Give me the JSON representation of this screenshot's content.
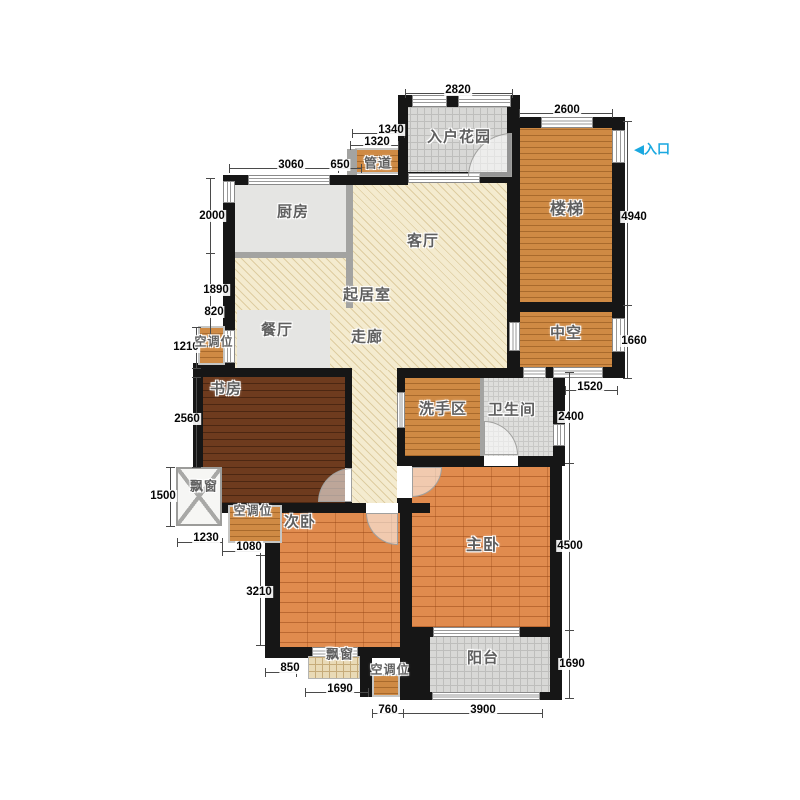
{
  "meta": {
    "title": "apartment-floor-plan",
    "canvas": {
      "w": 800,
      "h": 800
    }
  },
  "colors": {
    "wall": "#161616",
    "hatch_floor": "#f4ebcf",
    "wood_floor": "#cf8a44",
    "bedroom_floor": "#e08b4e",
    "study_floor": "#6e3b1e",
    "tile_floor": "#d8d8d6",
    "gray_floor": "#e5e5e3",
    "entrance_text": "#1aa8e0",
    "label_text": "#5f5f5f",
    "dim_text": "#060606"
  },
  "entrance": {
    "label": "入口",
    "arrow": "◀",
    "x": 652,
    "y": 148
  },
  "floors": [
    {
      "name": "living-room-floor",
      "cls": "f-hatch",
      "x": 235,
      "y": 180,
      "w": 273,
      "h": 190
    },
    {
      "name": "corridor-floor",
      "cls": "f-hatch",
      "x": 345,
      "y": 370,
      "w": 60,
      "h": 143
    },
    {
      "name": "kitchen-floor",
      "cls": "f-gray",
      "x": 235,
      "y": 183,
      "w": 112,
      "h": 70
    },
    {
      "name": "dining-floor",
      "cls": "f-gray",
      "x": 237,
      "y": 310,
      "w": 93,
      "h": 58
    },
    {
      "name": "entry-garden-floor",
      "cls": "f-tile",
      "x": 404,
      "y": 103,
      "w": 109,
      "h": 74
    },
    {
      "name": "stairs-floor",
      "cls": "f-wood",
      "x": 519,
      "y": 124,
      "w": 93,
      "h": 179
    },
    {
      "name": "hollow-floor",
      "cls": "f-wood",
      "x": 519,
      "y": 311,
      "w": 93,
      "h": 58
    },
    {
      "name": "duct-floor",
      "cls": "f-wood-framed",
      "x": 355,
      "y": 148,
      "w": 45,
      "h": 26
    },
    {
      "name": "study-floor",
      "cls": "f-wood-dark",
      "x": 203,
      "y": 377,
      "w": 142,
      "h": 126
    },
    {
      "name": "wash-area-floor",
      "cls": "f-wood",
      "x": 405,
      "y": 378,
      "w": 77,
      "h": 78
    },
    {
      "name": "bathroom-floor",
      "cls": "f-tile-dot",
      "x": 484,
      "y": 378,
      "w": 69,
      "h": 78
    },
    {
      "name": "master-bedroom-floor",
      "cls": "f-wood-bedroom",
      "x": 408,
      "y": 467,
      "w": 142,
      "h": 160
    },
    {
      "name": "second-bedroom-floor",
      "cls": "f-wood-bedroom",
      "x": 280,
      "y": 513,
      "w": 120,
      "h": 134
    },
    {
      "name": "balcony-floor",
      "cls": "f-tile",
      "x": 430,
      "y": 637,
      "w": 120,
      "h": 55
    }
  ],
  "partitions": [
    [
      346,
      183,
      7,
      125
    ],
    [
      235,
      252,
      118,
      6
    ],
    [
      480,
      378,
      4,
      78
    ],
    [
      347,
      149,
      10,
      26
    ]
  ],
  "walls": [
    [
      398,
      95,
      121,
      12
    ],
    [
      398,
      95,
      10,
      82
    ],
    [
      511,
      117,
      114,
      11
    ],
    [
      612,
      117,
      13,
      261
    ],
    [
      507,
      95,
      13,
      283
    ],
    [
      507,
      302,
      118,
      10
    ],
    [
      507,
      367,
      118,
      11
    ],
    [
      223,
      175,
      185,
      10
    ],
    [
      223,
      175,
      12,
      155
    ],
    [
      193,
      363,
      42,
      14
    ],
    [
      193,
      368,
      10,
      145
    ],
    [
      193,
      368,
      159,
      9
    ],
    [
      345,
      368,
      7,
      135
    ],
    [
      397,
      368,
      168,
      10
    ],
    [
      397,
      368,
      8,
      145
    ],
    [
      553,
      368,
      12,
      98
    ],
    [
      397,
      456,
      165,
      11
    ],
    [
      550,
      456,
      12,
      244
    ],
    [
      400,
      466,
      12,
      161
    ],
    [
      193,
      503,
      237,
      10
    ],
    [
      265,
      513,
      15,
      145
    ],
    [
      265,
      647,
      165,
      11
    ],
    [
      400,
      627,
      30,
      73
    ],
    [
      420,
      627,
      130,
      10
    ],
    [
      412,
      692,
      150,
      8
    ],
    [
      360,
      647,
      12,
      50
    ],
    [
      398,
      172,
      122,
      11
    ]
  ],
  "windows": [
    {
      "x": 412,
      "y": 95,
      "w": 35,
      "h": 12,
      "o": "h"
    },
    {
      "x": 458,
      "y": 95,
      "w": 53,
      "h": 12,
      "o": "h"
    },
    {
      "x": 541,
      "y": 117,
      "w": 52,
      "h": 11,
      "o": "h"
    },
    {
      "x": 612,
      "y": 130,
      "w": 13,
      "h": 33,
      "o": "v"
    },
    {
      "x": 612,
      "y": 318,
      "w": 13,
      "h": 34,
      "o": "v"
    },
    {
      "x": 509,
      "y": 322,
      "w": 11,
      "h": 29,
      "o": "v"
    },
    {
      "x": 523,
      "y": 367,
      "w": 23,
      "h": 11,
      "o": "h"
    },
    {
      "x": 553,
      "y": 367,
      "w": 50,
      "h": 11,
      "o": "h"
    },
    {
      "x": 223,
      "y": 181,
      "w": 12,
      "h": 22,
      "o": "v"
    },
    {
      "x": 248,
      "y": 175,
      "w": 82,
      "h": 10,
      "o": "h"
    },
    {
      "x": 408,
      "y": 173,
      "w": 72,
      "h": 10,
      "o": "h"
    },
    {
      "x": 397,
      "y": 392,
      "w": 8,
      "h": 36,
      "o": "v"
    },
    {
      "x": 553,
      "y": 424,
      "w": 12,
      "h": 22,
      "o": "v"
    },
    {
      "x": 223,
      "y": 330,
      "w": 12,
      "h": 33,
      "o": "v"
    },
    {
      "x": 433,
      "y": 627,
      "w": 87,
      "h": 10,
      "o": "h"
    },
    {
      "x": 432,
      "y": 692,
      "w": 108,
      "h": 8,
      "o": "h"
    },
    {
      "x": 312,
      "y": 647,
      "w": 46,
      "h": 11,
      "o": "h"
    }
  ],
  "door_openings": [
    [
      397,
      466,
      15,
      32
    ],
    [
      345,
      468,
      7,
      34
    ],
    [
      366,
      503,
      32,
      10
    ],
    [
      484,
      456,
      34,
      10
    ]
  ],
  "doors": [
    {
      "x": 468,
      "y": 133,
      "r": 44,
      "corner": "tl"
    },
    {
      "x": 318,
      "y": 468,
      "r": 34,
      "corner": "tl"
    },
    {
      "x": 366,
      "y": 513,
      "r": 32,
      "corner": "bl"
    },
    {
      "x": 412,
      "y": 467,
      "r": 30,
      "corner": "br"
    },
    {
      "x": 484,
      "y": 421,
      "r": 34,
      "corner": "tr"
    }
  ],
  "fixtures": [
    {
      "name": "ac-unit-upper-left",
      "cls": "f-wood-framed",
      "x": 198,
      "y": 326,
      "w": 27,
      "h": 39
    },
    {
      "name": "ac-unit-mid-left",
      "cls": "f-wood-framed",
      "x": 228,
      "y": 505,
      "w": 54,
      "h": 38
    },
    {
      "name": "ac-unit-bottom",
      "cls": "f-wood-framed",
      "x": 372,
      "y": 674,
      "w": 28,
      "h": 23
    },
    {
      "name": "bay-window-left",
      "cls": "f-bay",
      "x": 176,
      "y": 467,
      "w": 46,
      "h": 59
    },
    {
      "name": "bay-window-bottom",
      "cls": "f-tan-grid",
      "x": 308,
      "y": 656,
      "w": 52,
      "h": 23
    }
  ],
  "room_labels": [
    {
      "name": "entry-garden-label",
      "t": "入户花园",
      "x": 459,
      "y": 136,
      "fs": 15
    },
    {
      "name": "duct-label",
      "t": "管道",
      "x": 378,
      "y": 162,
      "fs": 13
    },
    {
      "name": "stairs-label",
      "t": "楼梯",
      "x": 567,
      "y": 207,
      "fs": 16
    },
    {
      "name": "hollow-label",
      "t": "中空",
      "x": 566,
      "y": 332,
      "fs": 15
    },
    {
      "name": "kitchen-label",
      "t": "厨房",
      "x": 293,
      "y": 211,
      "fs": 15
    },
    {
      "name": "living-room-label",
      "t": "客厅",
      "x": 423,
      "y": 240,
      "fs": 15
    },
    {
      "name": "sitting-room-label",
      "t": "起居室",
      "x": 367,
      "y": 294,
      "fs": 15
    },
    {
      "name": "dining-room-label",
      "t": "餐厅",
      "x": 277,
      "y": 329,
      "fs": 15
    },
    {
      "name": "corridor-label",
      "t": "走廊",
      "x": 367,
      "y": 336,
      "fs": 15
    },
    {
      "name": "ac-upper-label",
      "t": "空调位",
      "x": 214,
      "y": 341,
      "fs": 12
    },
    {
      "name": "study-label",
      "t": "书房",
      "x": 226,
      "y": 388,
      "fs": 15
    },
    {
      "name": "wash-area-label",
      "t": "洗手区",
      "x": 443,
      "y": 408,
      "fs": 15
    },
    {
      "name": "bathroom-label",
      "t": "卫生间",
      "x": 512,
      "y": 409,
      "fs": 15
    },
    {
      "name": "bay-left-label",
      "t": "飘窗",
      "x": 204,
      "y": 485,
      "fs": 13
    },
    {
      "name": "ac-mid-label",
      "t": "空调位",
      "x": 253,
      "y": 510,
      "fs": 12
    },
    {
      "name": "second-bedroom-label",
      "t": "次卧",
      "x": 300,
      "y": 521,
      "fs": 15
    },
    {
      "name": "master-bedroom-label",
      "t": "主卧",
      "x": 483,
      "y": 543,
      "fs": 16
    },
    {
      "name": "bay-bottom-label",
      "t": "飘窗",
      "x": 340,
      "y": 653,
      "fs": 13
    },
    {
      "name": "ac-bottom-label",
      "t": "空调位",
      "x": 390,
      "y": 669,
      "fs": 12
    },
    {
      "name": "balcony-label",
      "t": "阳台",
      "x": 483,
      "y": 657,
      "fs": 15
    }
  ],
  "dimensions": [
    {
      "t": "2820",
      "x": 458,
      "y": 90,
      "line": [
        405,
        93,
        512,
        93
      ]
    },
    {
      "t": "2600",
      "x": 567,
      "y": 110,
      "line": [
        519,
        113,
        612,
        113
      ]
    },
    {
      "t": "1340",
      "x": 391,
      "y": 130,
      "line": [
        352,
        133,
        404,
        133
      ]
    },
    {
      "t": "1320",
      "x": 377,
      "y": 142,
      "line": [
        350,
        145,
        398,
        145
      ]
    },
    {
      "t": "3060",
      "x": 291,
      "y": 165,
      "line": [
        229,
        168,
        338,
        168
      ]
    },
    {
      "t": "650",
      "x": 340,
      "y": 165,
      "line": [
        338,
        168,
        361,
        168
      ]
    },
    {
      "t": "2000",
      "x": 212,
      "y": 216,
      "line": [
        210,
        178,
        210,
        253
      ]
    },
    {
      "t": "1890",
      "x": 216,
      "y": 290,
      "line": [
        210,
        253,
        210,
        315
      ]
    },
    {
      "t": "820",
      "x": 214,
      "y": 312,
      "line": [
        210,
        315,
        210,
        346
      ]
    },
    {
      "t": "1210",
      "x": 186,
      "y": 347,
      "line": [
        196,
        327,
        196,
        368
      ]
    },
    {
      "t": "2560",
      "x": 187,
      "y": 419,
      "line": [
        196,
        377,
        196,
        467
      ]
    },
    {
      "t": "1500",
      "x": 163,
      "y": 496,
      "line": [
        170,
        467,
        170,
        526
      ]
    },
    {
      "t": "1230",
      "x": 206,
      "y": 538,
      "line": [
        177,
        542,
        222,
        542
      ]
    },
    {
      "t": "1080",
      "x": 249,
      "y": 547,
      "line": [
        222,
        551,
        260,
        551
      ]
    },
    {
      "t": "3210",
      "x": 259,
      "y": 592,
      "line": [
        260,
        555,
        260,
        645
      ]
    },
    {
      "t": "850",
      "x": 290,
      "y": 668,
      "line": [
        265,
        672,
        296,
        672
      ]
    },
    {
      "t": "1690",
      "x": 340,
      "y": 689,
      "line": [
        305,
        692,
        368,
        692
      ]
    },
    {
      "t": "760",
      "x": 388,
      "y": 710,
      "line": [
        372,
        713,
        403,
        713
      ]
    },
    {
      "t": "3900",
      "x": 483,
      "y": 710,
      "line": [
        403,
        713,
        542,
        713
      ]
    },
    {
      "t": "4940",
      "x": 634,
      "y": 217,
      "line": [
        627,
        121,
        627,
        305
      ]
    },
    {
      "t": "1660",
      "x": 634,
      "y": 341,
      "line": [
        627,
        305,
        627,
        378
      ]
    },
    {
      "t": "1520",
      "x": 590,
      "y": 387,
      "line": [
        565,
        390,
        617,
        390
      ]
    },
    {
      "t": "2400",
      "x": 571,
      "y": 417,
      "line": [
        569,
        372,
        569,
        463
      ]
    },
    {
      "t": "4500",
      "x": 570,
      "y": 546,
      "line": [
        569,
        463,
        569,
        630
      ]
    },
    {
      "t": "1690",
      "x": 572,
      "y": 664,
      "line": [
        569,
        630,
        569,
        698
      ]
    }
  ]
}
